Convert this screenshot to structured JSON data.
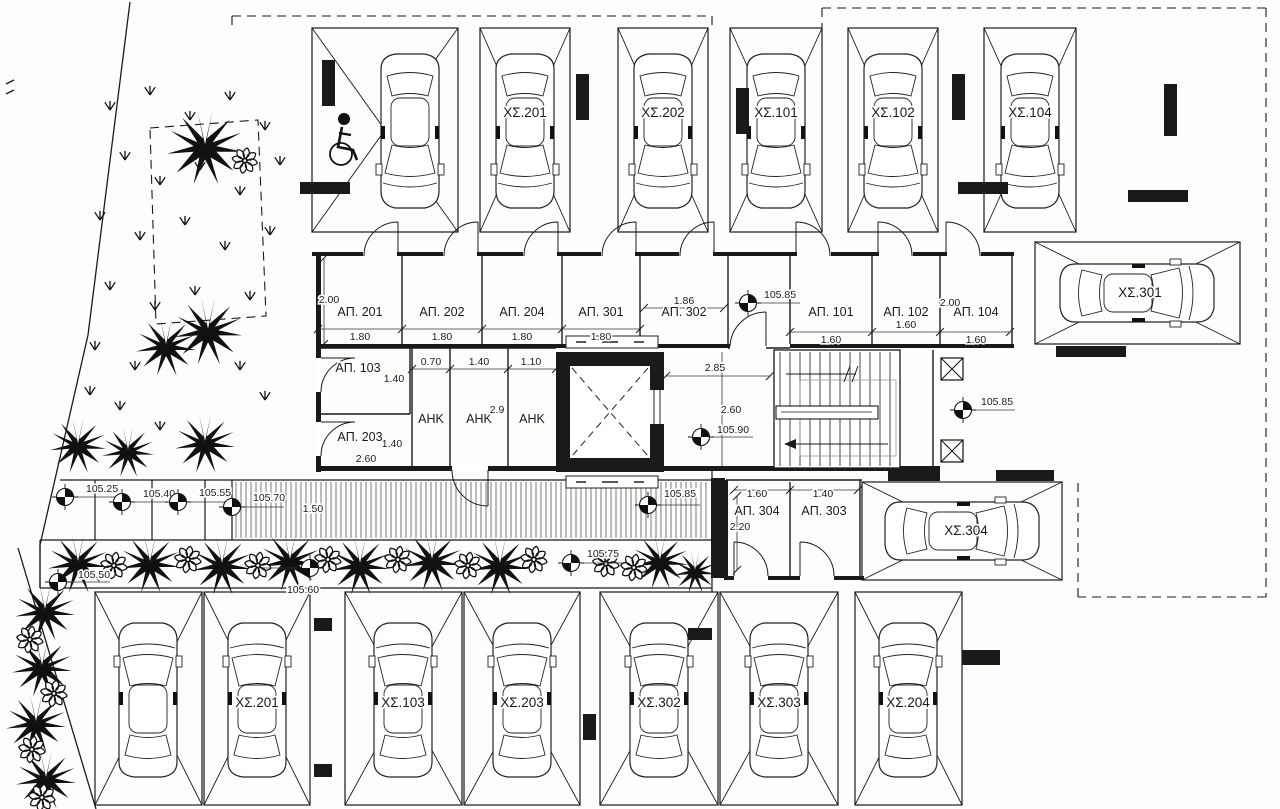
{
  "parking": {
    "top": [
      "ΧΣ.201",
      "ΧΣ.202",
      "ΧΣ.101",
      "ΧΣ.102",
      "ΧΣ.104"
    ],
    "right_upper": "ΧΣ.301",
    "mid_right": "ΧΣ.304",
    "bottom": [
      "ΧΣ.201",
      "ΧΣ.103",
      "ΧΣ.203",
      "ΧΣ.302",
      "ΧΣ.303",
      "ΧΣ.204"
    ]
  },
  "storage": {
    "row_a": [
      "ΑΠ. 201",
      "ΑΠ. 202",
      "ΑΠ. 204",
      "ΑΠ. 301",
      "ΑΠ. 302"
    ],
    "row_b": [
      "ΑΠ. 101",
      "ΑΠ. 102",
      "ΑΠ. 104"
    ],
    "west_upper": "ΑΠ. 103",
    "west_lower": "ΑΠ. 203",
    "south": [
      "ΑΠ. 304",
      "ΑΠ. 303"
    ]
  },
  "utility": {
    "rooms": [
      "ΑΗΚ",
      "ΑΗΚ",
      "ΑΗΚ"
    ]
  },
  "dimensions": {
    "row_a_widths": [
      "1.80",
      "1.80",
      "1.80",
      "1.80",
      "1.86"
    ],
    "row_a_depth": "2.00",
    "row_b_widths": [
      "1.60",
      "1.60",
      "1.60"
    ],
    "row_b_depth": "2.00",
    "ap103_depth": "1.40",
    "ap203_depth": "1.40",
    "ap203_width": "2.60",
    "ahk_widths": [
      "0.70",
      "1.40",
      "1.10"
    ],
    "ahk_depth": "2.9",
    "lobby_width": "2.85",
    "lobby_depth": "2.60",
    "ap304_width": "1.60",
    "ap303_width": "1.40",
    "ap304_depth": "2.20",
    "ramp_width": "1.50"
  },
  "elevations": {
    "left": [
      "105.25",
      "105.40",
      "105.55",
      "105.70"
    ],
    "corridor_top": "105.85",
    "lobby": "105.90",
    "corridor_right": "105.85",
    "walkway_west": "105.50",
    "walkway_mid": "105.60",
    "walkway_east": "105.75",
    "walkway_end": "105.85"
  }
}
